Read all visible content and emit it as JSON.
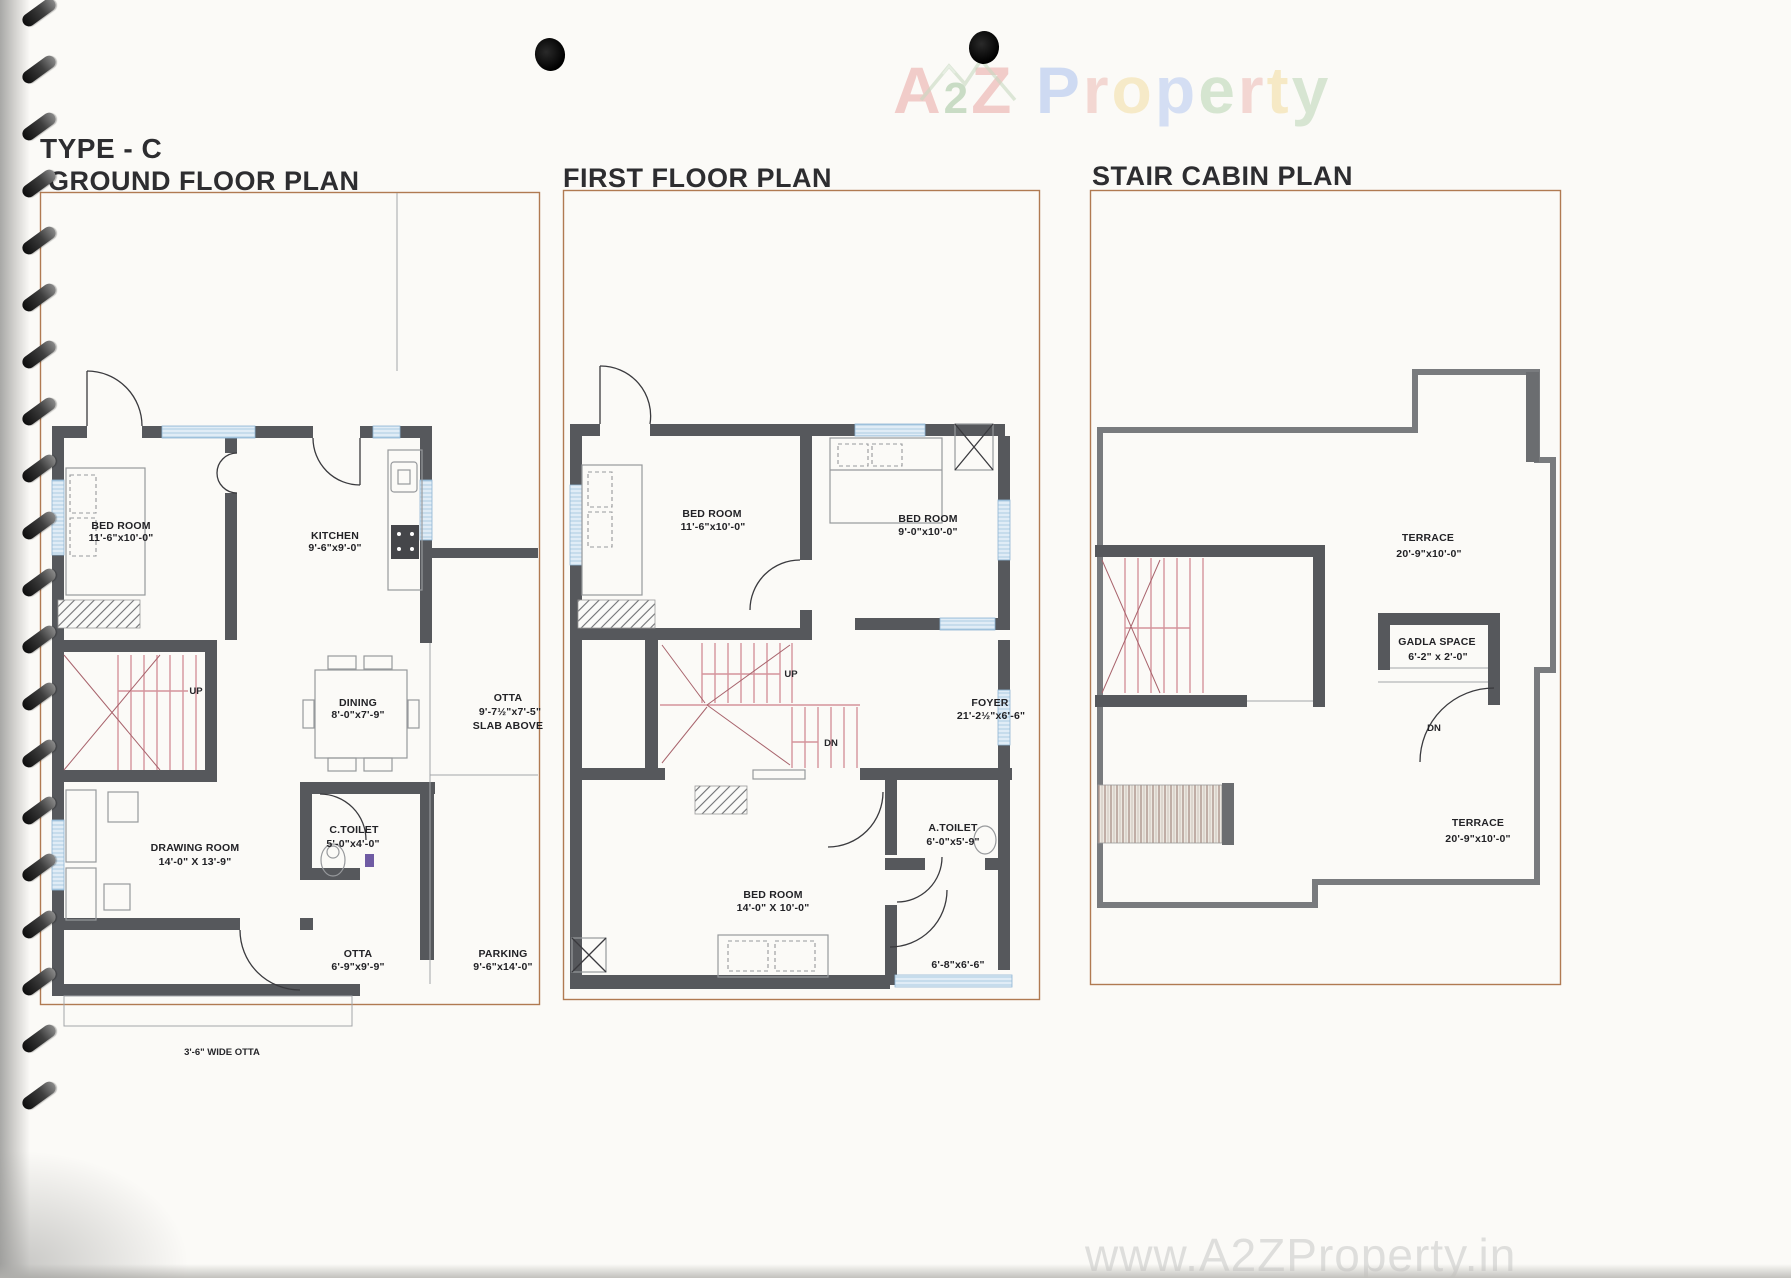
{
  "page": {
    "type_label": "TYPE - C",
    "website": "www.A2ZProperty.in",
    "brand": {
      "text": "A2Z Property",
      "letters": [
        {
          "ch": "A",
          "color": "#eaa7a4",
          "size": 66
        },
        {
          "ch": "2",
          "color": "#a2c49d",
          "size": 44
        },
        {
          "ch": "Z",
          "color": "#eaa7a4",
          "size": 66
        },
        {
          "ch": " ",
          "color": "#ffffff",
          "size": 66
        },
        {
          "ch": "P",
          "color": "#aac1ee",
          "size": 66
        },
        {
          "ch": "r",
          "color": "#edbcb4",
          "size": 66
        },
        {
          "ch": "o",
          "color": "#f3dda2",
          "size": 66
        },
        {
          "ch": "p",
          "color": "#b5c8f0",
          "size": 66
        },
        {
          "ch": "e",
          "color": "#b7d5b1",
          "size": 66
        },
        {
          "ch": "r",
          "color": "#eebab5",
          "size": 66
        },
        {
          "ch": "t",
          "color": "#f2dc9e",
          "size": 66
        },
        {
          "ch": "y",
          "color": "#bad4b4",
          "size": 66
        }
      ]
    }
  },
  "colors": {
    "wall": "#56585c",
    "panel_border": "#b07a52",
    "window": "#8fb6d4",
    "stair": "#d4939c"
  },
  "plans": [
    {
      "title": "GROUND FLOOR PLAN",
      "rooms": [
        {
          "name": "BED ROOM",
          "size": "11'-6\"x10'-0\""
        },
        {
          "name": "KITCHEN",
          "size": "9'-6\"x9'-0\""
        },
        {
          "name": "DINING",
          "size": "8'-0\"x7'-9\""
        },
        {
          "name": "OTTA",
          "size": "9'-7½\"x7'-5\"",
          "note": "SLAB ABOVE"
        },
        {
          "name": "DRAWING ROOM",
          "size": "14'-0\" X 13'-9\""
        },
        {
          "name": "C.TOILET",
          "size": "5'-0\"x4'-0\""
        },
        {
          "name": "OTTA",
          "size": "6'-9\"x9'-9\""
        },
        {
          "name": "PARKING",
          "size": "9'-6\"x14'-0\""
        }
      ],
      "stair_up": "UP",
      "annotation": "3'-6\" WIDE OTTA"
    },
    {
      "title": "FIRST FLOOR PLAN",
      "rooms": [
        {
          "name": "BED ROOM",
          "size": "11'-6\"x10'-0\""
        },
        {
          "name": "BED ROOM",
          "size": "9'-0\"x10'-0\""
        },
        {
          "name": "FOYER",
          "size": "21'-2½\"x6'-6\""
        },
        {
          "name": "BED ROOM",
          "size": "14'-0\" X 10'-0\""
        },
        {
          "name": "A.TOILET",
          "size": "6'-0\"x5'-9\""
        },
        {
          "name": "BALCONY",
          "size": "6'-8\"x6'-6\""
        }
      ],
      "stair_up": "UP",
      "stair_dn": "DN"
    },
    {
      "title": "STAIR CABIN PLAN",
      "rooms": [
        {
          "name": "TERRACE",
          "size": "20'-9\"x10'-0\""
        },
        {
          "name": "GADLA SPACE",
          "size": "6'-2\" x 2'-0\""
        },
        {
          "name": "TERRACE",
          "size": "20'-9\"x10'-0\""
        }
      ],
      "stair_dn": "DN"
    }
  ]
}
